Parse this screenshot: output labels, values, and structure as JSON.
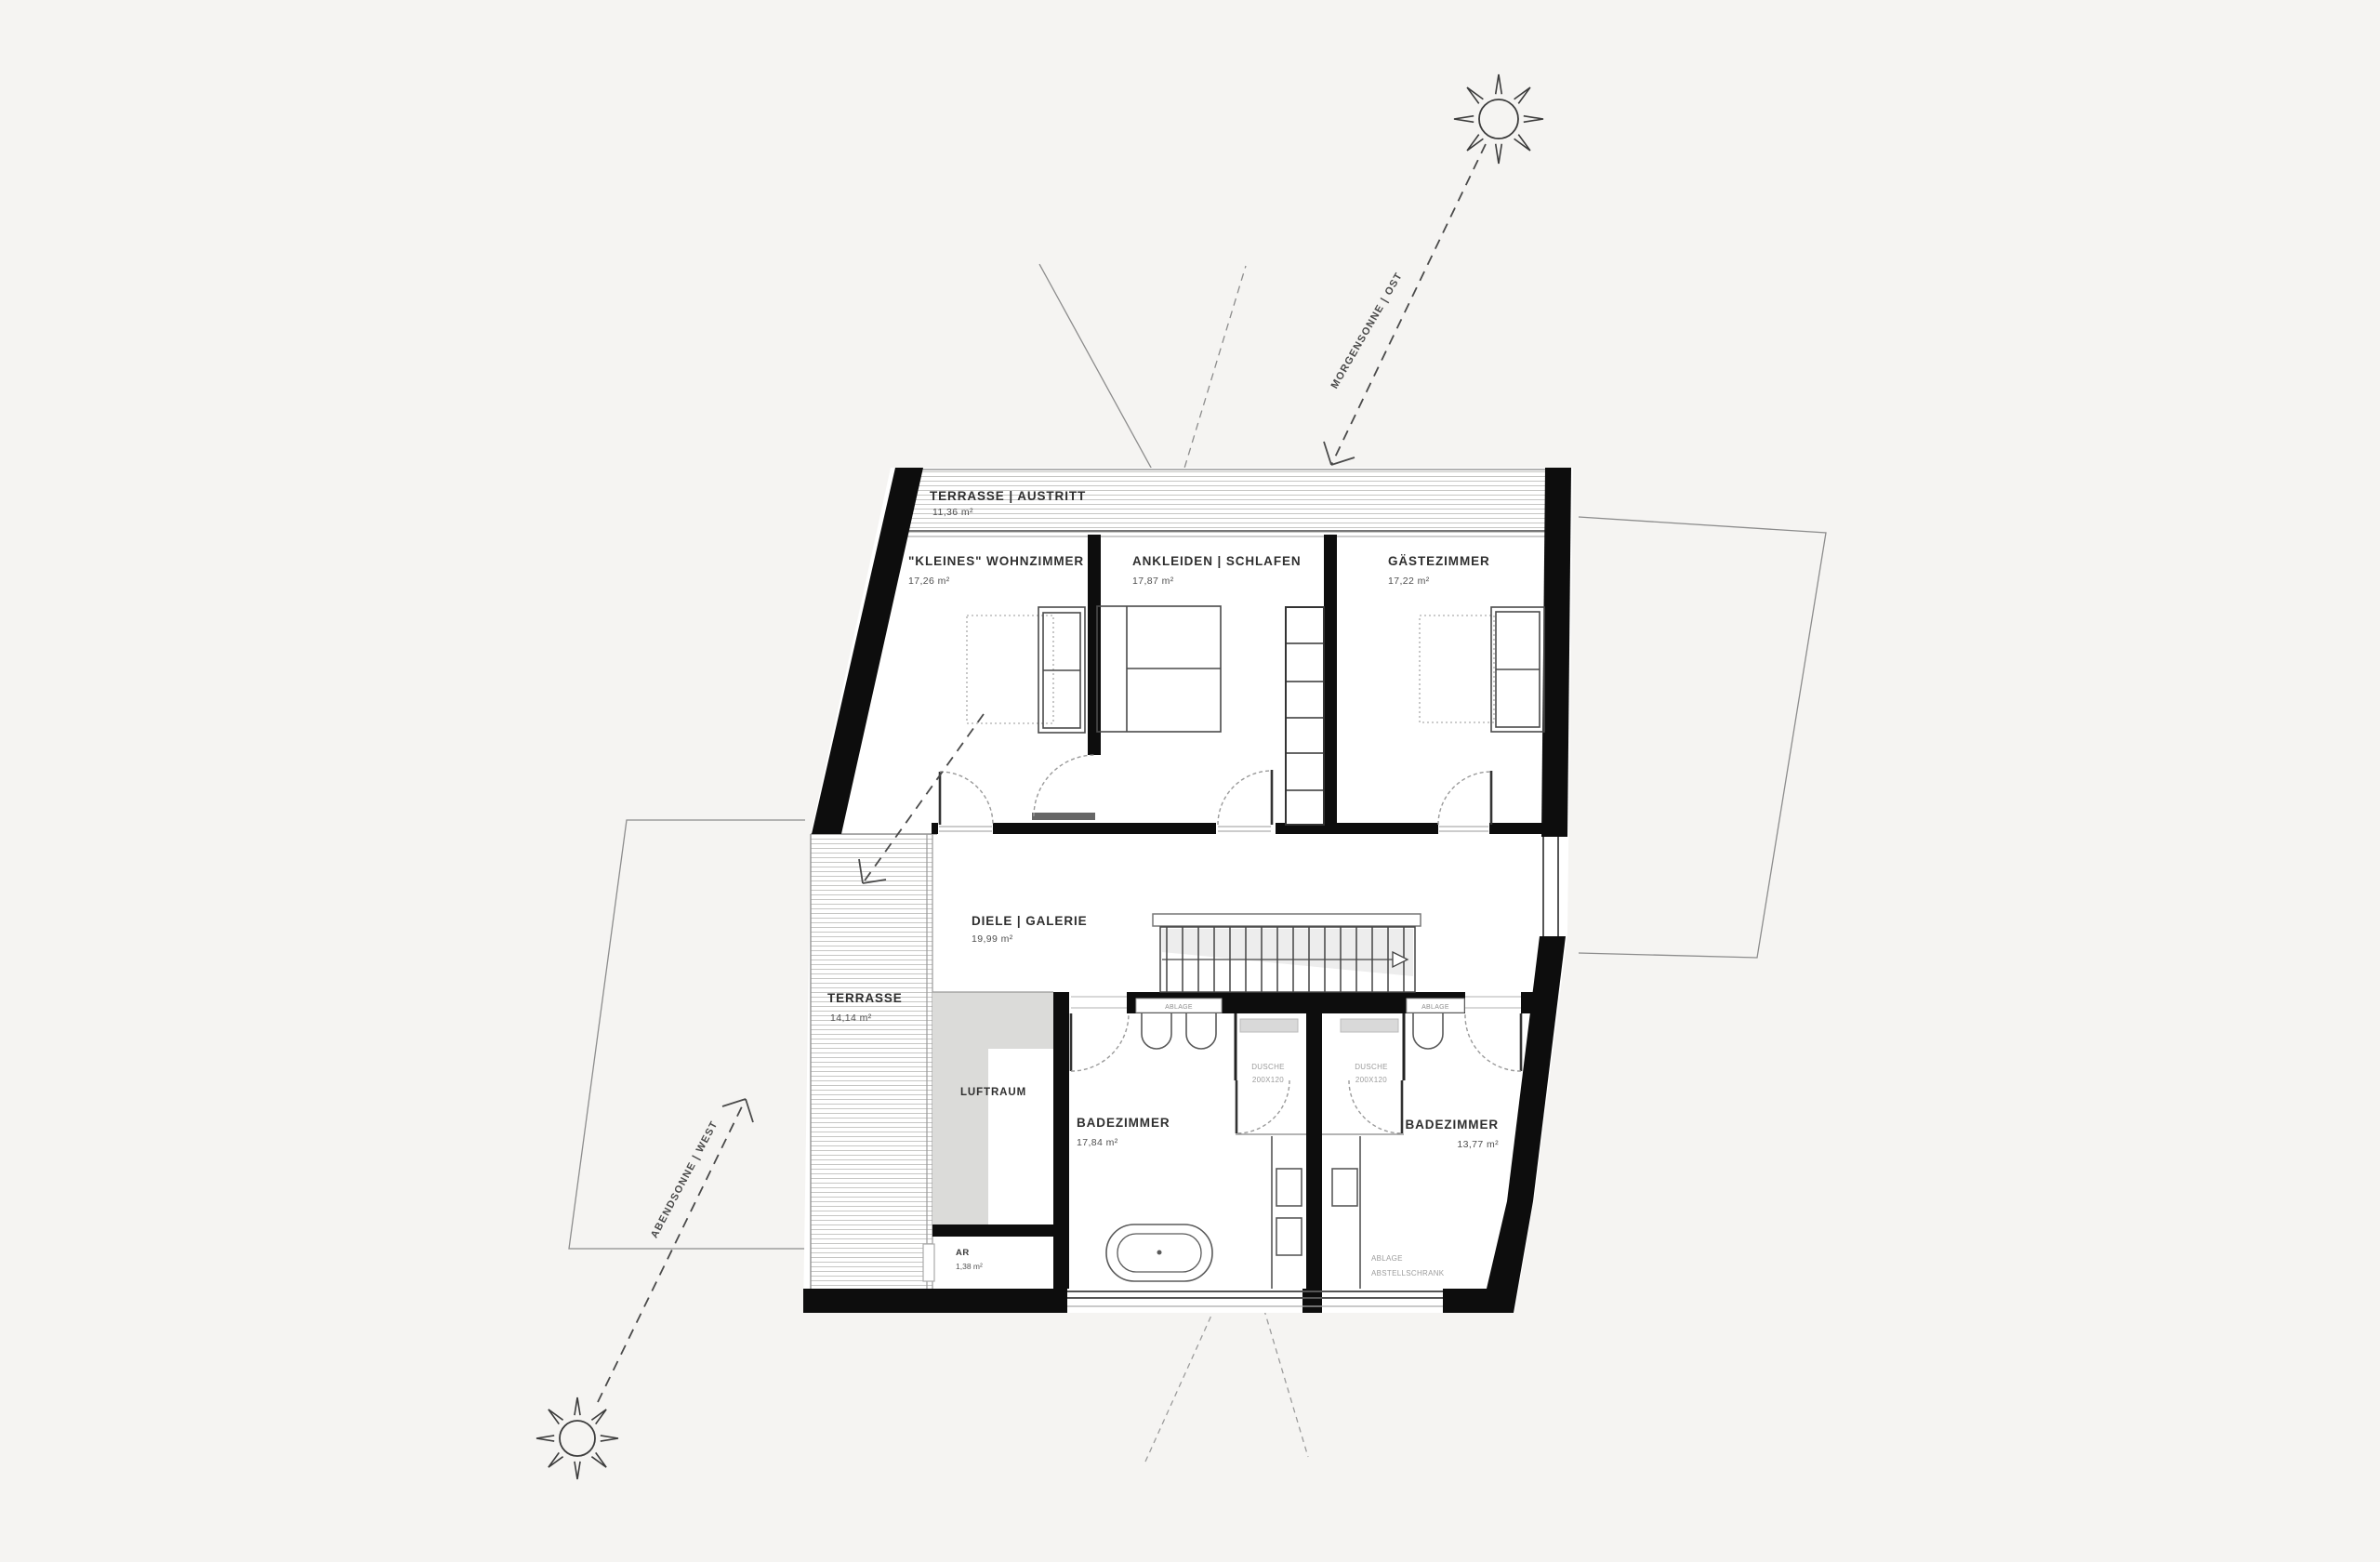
{
  "plan": {
    "rooms": {
      "terrace_top": {
        "label": "TERRASSE | AUSTRITT",
        "area": "11,36 m²"
      },
      "living": {
        "label": "\"KLEINES\" WOHNZIMMER",
        "area": "17,26 m²"
      },
      "dressing": {
        "label": "ANKLEIDEN | SCHLAFEN",
        "area": "17,87 m²"
      },
      "guest": {
        "label": "GÄSTEZIMMER",
        "area": "17,22 m²"
      },
      "hall": {
        "label": "DIELE | GALERIE",
        "area": "19,99 m²"
      },
      "terrace_west": {
        "label": "TERRASSE",
        "area": "14,14 m²"
      },
      "void": {
        "label": "LUFTRAUM"
      },
      "bath_west": {
        "label": "BADEZIMMER",
        "area": "17,84 m²"
      },
      "bath_east": {
        "label": "BADEZIMMER",
        "area": "13,77 m²"
      },
      "storage": {
        "label": "AR",
        "area": "1,38 m²"
      }
    },
    "annotations": {
      "morning_sun": "MORGENSONNE | OST",
      "evening_sun": "ABENDSONNE | WEST",
      "shower": {
        "l1": "DUSCHE",
        "l2": "200X120"
      },
      "shelf": "ABLAGE",
      "closet": {
        "l1": "ABLAGE",
        "l2": "ABSTELLSCHRANK"
      }
    },
    "colors": {
      "background": "#f5f4f2",
      "wall": "#0d0d0d",
      "hatch": "#c6c6c4",
      "void_fill": "#dbdbd9",
      "text": "#2f2f2f",
      "muted": "#9c9c9c"
    }
  }
}
